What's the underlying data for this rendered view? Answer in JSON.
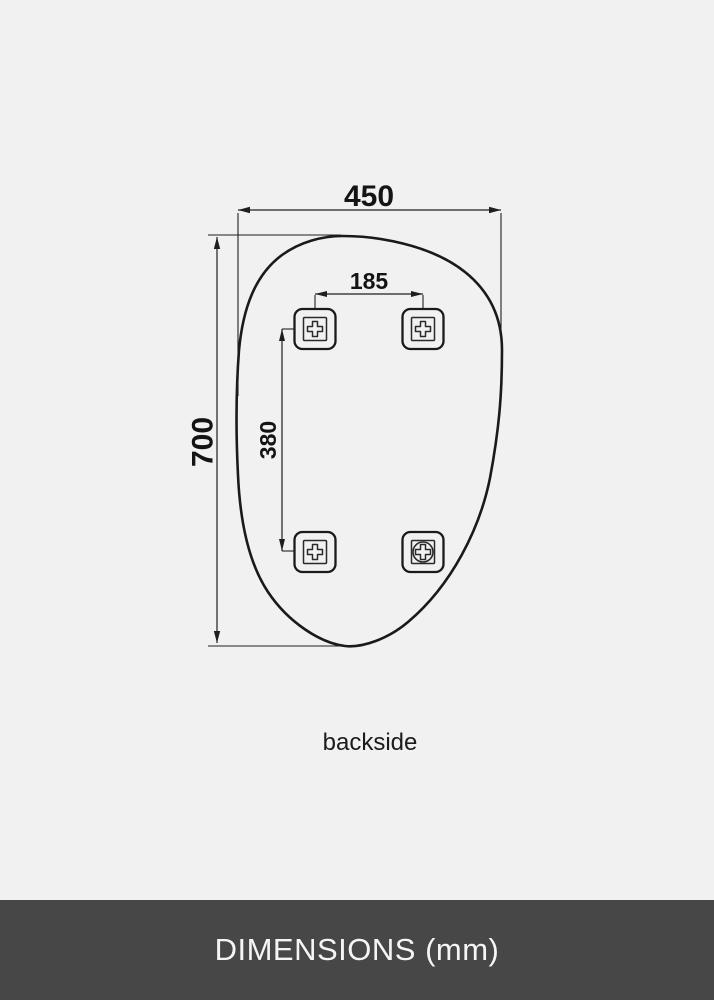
{
  "diagram": {
    "view_label": "backside",
    "unit": "mm",
    "dimensions": {
      "width_mm": "450",
      "height_mm": "700",
      "bracket_spacing_horizontal_mm": "185",
      "bracket_spacing_vertical_mm": "380"
    },
    "brackets": {
      "count": 4,
      "types": [
        "cross-mount",
        "cross-mount",
        "cross-mount",
        "screw-mount"
      ]
    },
    "colors": {
      "background": "#f1f1f1",
      "line": "#1a1a1a"
    }
  },
  "footer": {
    "title": "DIMENSIONS (mm)",
    "background": "#474747",
    "text_color": "#f5f5f5"
  }
}
